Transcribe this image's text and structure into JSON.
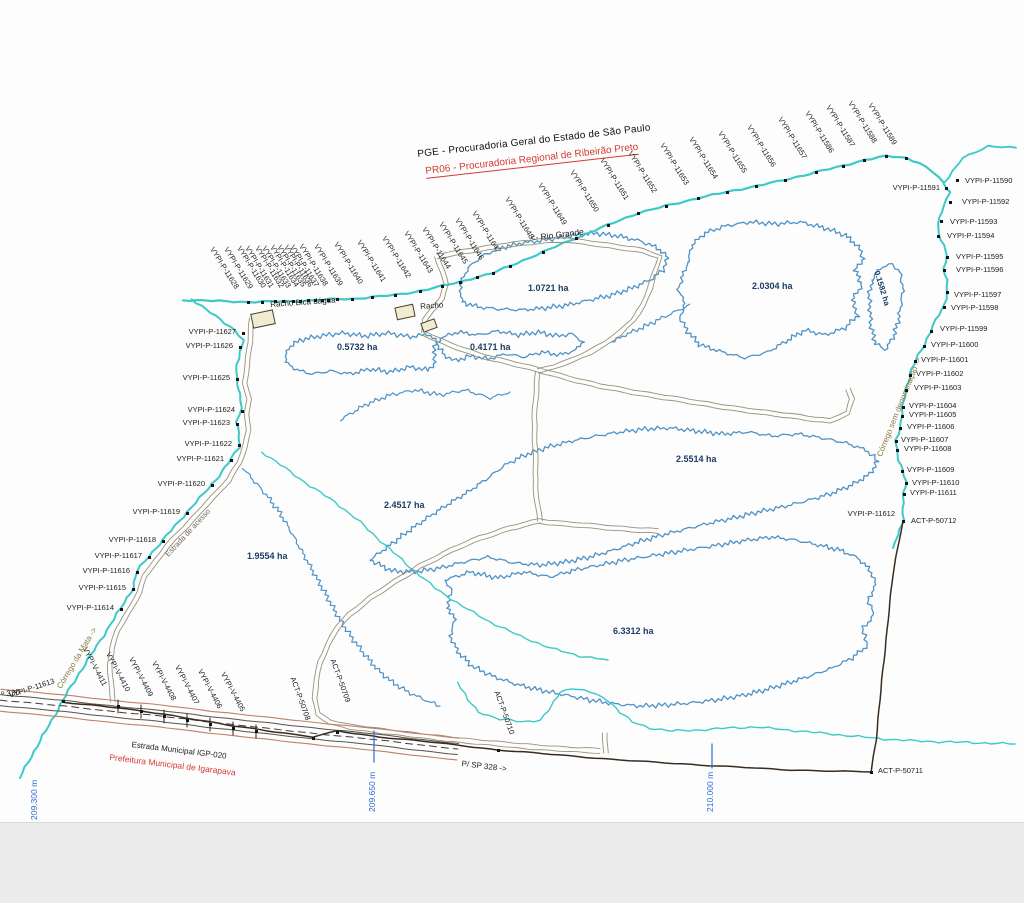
{
  "title": {
    "line1": "PGE - Procuradoria Geral do Estado de São Paulo",
    "line2": "PR06 - Procuradoria Regional de Ribeirão Preto"
  },
  "map": {
    "colors": {
      "stream": "#3ec9c9",
      "polygon": "#4f92c6",
      "road": "#98927a",
      "boundary": "#3a2b1e",
      "highway_edge": "#c08166",
      "highway_inner": "#57524a",
      "label": "#1c1c1c",
      "area_label": "#1c3e63",
      "red": "#d43a31",
      "coord_blue": "#2b6bd6",
      "stream_label": "#8a7b46",
      "building_fill": "#f1ebd0"
    },
    "areas_ha": [
      "0.5732",
      "0.4171",
      "1.0721",
      "2.0304",
      "0.1582",
      "2.5514",
      "2.4517",
      "1.9554",
      "6.3312"
    ],
    "labels": [
      {
        "t": "VYPI-P-11628",
        "x": 215,
        "y": 246,
        "r": 58,
        "c": "rt"
      },
      {
        "t": "VYPI-P-11629",
        "x": 229,
        "y": 246,
        "r": 58,
        "c": "rt"
      },
      {
        "t": "VYPI-P-11630",
        "x": 242,
        "y": 245,
        "r": 58,
        "c": "rt"
      },
      {
        "t": "VYPI-P-11631",
        "x": 250,
        "y": 245,
        "r": 58,
        "c": "rt"
      },
      {
        "t": "VYPI-P-11632",
        "x": 260,
        "y": 245,
        "r": 58,
        "c": "rt"
      },
      {
        "t": "VYPI-P-11633",
        "x": 267,
        "y": 245,
        "r": 58,
        "c": "rt"
      },
      {
        "t": "VYPI-P-11634",
        "x": 275,
        "y": 244,
        "r": 58,
        "c": "rt"
      },
      {
        "t": "VYPI-P-11635",
        "x": 282,
        "y": 244,
        "r": 58,
        "c": "rt"
      },
      {
        "t": "VYPI-P-11636",
        "x": 289,
        "y": 244,
        "r": 58,
        "c": "rt"
      },
      {
        "t": "VYPI-P-11637",
        "x": 295,
        "y": 244,
        "r": 58,
        "c": "rt"
      },
      {
        "t": "VYPI-P-11638",
        "x": 304,
        "y": 243,
        "r": 58,
        "c": "rt"
      },
      {
        "t": "VYPI-P-11639",
        "x": 319,
        "y": 243,
        "r": 58,
        "c": "rt"
      },
      {
        "t": "VYPI-P-11640",
        "x": 339,
        "y": 241,
        "r": 58,
        "c": "rt"
      },
      {
        "t": "VYPI-P-11641",
        "x": 362,
        "y": 239,
        "r": 58,
        "c": "rt"
      },
      {
        "t": "VYPI-P-11642",
        "x": 387,
        "y": 235,
        "r": 58,
        "c": "rt"
      },
      {
        "t": "VYPI-P-11643",
        "x": 409,
        "y": 230,
        "r": 58,
        "c": "rt"
      },
      {
        "t": "VYPI-P-11644",
        "x": 427,
        "y": 226,
        "r": 58,
        "c": "rt"
      },
      {
        "t": "VYPI-P-11645",
        "x": 444,
        "y": 221,
        "r": 58,
        "c": "rt"
      },
      {
        "t": "VYPI-P-11646",
        "x": 460,
        "y": 217,
        "r": 58,
        "c": "rt"
      },
      {
        "t": "VYPI-P-11647",
        "x": 477,
        "y": 210,
        "r": 58,
        "c": "rt"
      },
      {
        "t": "VYPI-P-11648",
        "x": 510,
        "y": 196,
        "r": 58,
        "c": "rt"
      },
      {
        "t": "VYPI-P-11649",
        "x": 543,
        "y": 182,
        "r": 58,
        "c": "rt"
      },
      {
        "t": "VYPI-P-11650",
        "x": 575,
        "y": 169,
        "r": 58,
        "c": "rt"
      },
      {
        "t": "VYPI-P-11651",
        "x": 605,
        "y": 157,
        "r": 58,
        "c": "rt"
      },
      {
        "t": "VYPI-P-11652",
        "x": 633,
        "y": 150,
        "r": 58,
        "c": "rt"
      },
      {
        "t": "VYPI-P-11653",
        "x": 665,
        "y": 142,
        "r": 58,
        "c": "rt"
      },
      {
        "t": "VYPI-P-11654",
        "x": 694,
        "y": 136,
        "r": 58,
        "c": "rt"
      },
      {
        "t": "VYPI-P-11655",
        "x": 723,
        "y": 130,
        "r": 58,
        "c": "rt"
      },
      {
        "t": "VYPI-P-11656",
        "x": 752,
        "y": 124,
        "r": 58,
        "c": "rt"
      },
      {
        "t": "VYPI-P-11657",
        "x": 783,
        "y": 116,
        "r": 58,
        "c": "rt"
      },
      {
        "t": "VYPI-P-11586",
        "x": 810,
        "y": 110,
        "r": 58,
        "c": "rt"
      },
      {
        "t": "VYPI-P-11587",
        "x": 831,
        "y": 104,
        "r": 58,
        "c": "rt"
      },
      {
        "t": "VYPI-P-11588",
        "x": 853,
        "y": 100,
        "r": 58,
        "c": "rt"
      },
      {
        "t": "VYPI-P-11589",
        "x": 873,
        "y": 102,
        "r": 58,
        "c": "rt"
      },
      {
        "t": "VYPI-P-11590",
        "x": 965,
        "y": 177,
        "c": "pt"
      },
      {
        "t": "VYPI-P-11591",
        "x": 940,
        "y": 184,
        "c": "ra"
      },
      {
        "t": "VYPI-P-11592",
        "x": 962,
        "y": 198,
        "c": "pt"
      },
      {
        "t": "VYPI-P-11593",
        "x": 950,
        "y": 218,
        "c": "pt"
      },
      {
        "t": "VYPI-P-11594",
        "x": 947,
        "y": 232,
        "c": "pt"
      },
      {
        "t": "VYPI-P-11595",
        "x": 956,
        "y": 253,
        "c": "pt"
      },
      {
        "t": "VYPI-P-11596",
        "x": 956,
        "y": 266,
        "c": "pt"
      },
      {
        "t": "VYPI-P-11597",
        "x": 954,
        "y": 291,
        "c": "pt"
      },
      {
        "t": "VYPI-P-11598",
        "x": 951,
        "y": 304,
        "c": "pt"
      },
      {
        "t": "VYPI-P-11599",
        "x": 940,
        "y": 325,
        "c": "pt"
      },
      {
        "t": "VYPI-P-11600",
        "x": 931,
        "y": 341,
        "c": "pt"
      },
      {
        "t": "VYPI-P-11601",
        "x": 921,
        "y": 356,
        "c": "pt"
      },
      {
        "t": "VYPI-P-11602",
        "x": 916,
        "y": 370,
        "c": "pt"
      },
      {
        "t": "VYPI-P-11603",
        "x": 914,
        "y": 384,
        "c": "pt"
      },
      {
        "t": "VYPI-P-11604",
        "x": 909,
        "y": 402,
        "c": "pt"
      },
      {
        "t": "VYPI-P-11605",
        "x": 909,
        "y": 411,
        "c": "pt"
      },
      {
        "t": "VYPI-P-11606",
        "x": 907,
        "y": 423,
        "c": "pt"
      },
      {
        "t": "VYPI-P-11607",
        "x": 901,
        "y": 436,
        "c": "pt"
      },
      {
        "t": "VYPI-P-11608",
        "x": 904,
        "y": 445,
        "c": "pt"
      },
      {
        "t": "VYPI-P-11609",
        "x": 907,
        "y": 466,
        "c": "pt"
      },
      {
        "t": "VYPI-P-11610",
        "x": 912,
        "y": 479,
        "c": "pt"
      },
      {
        "t": "VYPI-P-11611",
        "x": 910,
        "y": 489,
        "c": "pt"
      },
      {
        "t": "VYPI-P-11612",
        "x": 895,
        "y": 510,
        "c": "ra"
      },
      {
        "t": "ACT-P-50712",
        "x": 911,
        "y": 517,
        "c": "pt"
      },
      {
        "t": "VYPI-P-11627",
        "x": 236,
        "y": 328,
        "c": "ra"
      },
      {
        "t": "VYPI-P-11626",
        "x": 233,
        "y": 342,
        "c": "ra"
      },
      {
        "t": "VYPI-P-11625",
        "x": 230,
        "y": 374,
        "c": "ra"
      },
      {
        "t": "VYPI-P-11624",
        "x": 235,
        "y": 406,
        "c": "ra"
      },
      {
        "t": "VYPI-P-11623",
        "x": 230,
        "y": 419,
        "c": "ra"
      },
      {
        "t": "VYPI-P-11622",
        "x": 232,
        "y": 440,
        "c": "ra"
      },
      {
        "t": "VYPI-P-11621",
        "x": 224,
        "y": 455,
        "c": "ra"
      },
      {
        "t": "VYPI-P-11620",
        "x": 205,
        "y": 480,
        "c": "ra"
      },
      {
        "t": "VYPI-P-11619",
        "x": 180,
        "y": 508,
        "c": "ra"
      },
      {
        "t": "VYPI-P-11618",
        "x": 156,
        "y": 536,
        "c": "ra"
      },
      {
        "t": "VYPI-P-11617",
        "x": 142,
        "y": 552,
        "c": "ra"
      },
      {
        "t": "VYPI-P-11616",
        "x": 130,
        "y": 567,
        "c": "ra"
      },
      {
        "t": "VYPI-P-11615",
        "x": 126,
        "y": 584,
        "c": "ra"
      },
      {
        "t": "VYPI-P-11614",
        "x": 114,
        "y": 604,
        "c": "ra"
      },
      {
        "t": "VYPI-P-11613",
        "x": 8,
        "y": 692,
        "r": -18,
        "c": "pt"
      },
      {
        "t": "VYPI-V-4411",
        "x": 88,
        "y": 646,
        "r": 62,
        "c": "rt"
      },
      {
        "t": "VYPI-V-4410",
        "x": 111,
        "y": 651,
        "r": 62,
        "c": "rt"
      },
      {
        "t": "VYPI-V-4409",
        "x": 134,
        "y": 656,
        "r": 62,
        "c": "rt"
      },
      {
        "t": "VYPI-V-4408",
        "x": 157,
        "y": 660,
        "r": 62,
        "c": "rt"
      },
      {
        "t": "VYPI-V-4407",
        "x": 180,
        "y": 664,
        "r": 62,
        "c": "rt"
      },
      {
        "t": "VYPI-V-4406",
        "x": 203,
        "y": 668,
        "r": 62,
        "c": "rt"
      },
      {
        "t": "VYPI-V-4405",
        "x": 226,
        "y": 671,
        "r": 62,
        "c": "rt"
      },
      {
        "t": "ACT-P-50708",
        "x": 296,
        "y": 676,
        "r": 70,
        "c": "rt"
      },
      {
        "t": "ACT-P-50709",
        "x": 336,
        "y": 658,
        "r": 70,
        "c": "rt"
      },
      {
        "t": "ACT-P-50710",
        "x": 500,
        "y": 690,
        "r": 70,
        "c": "rt"
      },
      {
        "t": "ACT-P-50711",
        "x": 878,
        "y": 767,
        "c": "pt"
      },
      {
        "t": "0.5732 ha",
        "x": 337,
        "y": 343,
        "c": "area"
      },
      {
        "t": "0.4171 ha",
        "x": 470,
        "y": 343,
        "c": "area"
      },
      {
        "t": "1.0721 ha",
        "x": 528,
        "y": 284,
        "c": "area"
      },
      {
        "t": "2.0304 ha",
        "x": 752,
        "y": 282,
        "c": "area"
      },
      {
        "t": "0.1582 ha",
        "x": 880,
        "y": 270,
        "r": 73,
        "c": "areaR"
      },
      {
        "t": "2.5514 ha",
        "x": 676,
        "y": 455,
        "c": "area"
      },
      {
        "t": "2.4517 ha",
        "x": 384,
        "y": 501,
        "c": "area"
      },
      {
        "t": "1.9554 ha",
        "x": 247,
        "y": 552,
        "c": "area"
      },
      {
        "t": "6.3312 ha",
        "x": 613,
        "y": 627,
        "c": "area"
      },
      {
        "t": "<- Rio Grande",
        "x": 530,
        "y": 234,
        "r": -7,
        "c": "rio"
      },
      {
        "t": "Racho Bica dágua",
        "x": 270,
        "y": 301,
        "r": -4,
        "c": "blk"
      },
      {
        "t": "Racho",
        "x": 420,
        "y": 303,
        "r": -4,
        "c": "blk"
      },
      {
        "t": "Córrego da Mata ->",
        "x": 56,
        "y": 686,
        "r": -59,
        "c": "stream"
      },
      {
        "t": "Córrego sem denominação ->",
        "x": 876,
        "y": 455,
        "r": -68,
        "c": "stream"
      },
      {
        "t": "Estrada de acesso",
        "x": 164,
        "y": 553,
        "r": -47,
        "c": "roadlbl"
      },
      {
        "t": "Estrada Municipal IGP-020",
        "x": 132,
        "y": 741,
        "r": 7,
        "c": "blk"
      },
      {
        "t": "Prefeitura Municipal de Igarapava",
        "x": 110,
        "y": 753,
        "r": 7,
        "c": "red"
      },
      {
        "t": "P/ SP 328 ->",
        "x": 462,
        "y": 760,
        "r": 7,
        "c": "blk"
      },
      {
        "t": "º 330",
        "x": 1,
        "y": 691,
        "r": -8,
        "c": "blk"
      },
      {
        "t": "209.300 m",
        "x": 30,
        "y": 820,
        "r": -90,
        "c": "coord"
      },
      {
        "t": "209.650 m",
        "x": 368,
        "y": 812,
        "r": -90,
        "c": "coord"
      },
      {
        "t": "210.000 m",
        "x": 706,
        "y": 812,
        "r": -90,
        "c": "coord"
      }
    ],
    "survey_points": [
      [
        248,
        302
      ],
      [
        262,
        302
      ],
      [
        275,
        301
      ],
      [
        283,
        301
      ],
      [
        293,
        301
      ],
      [
        300,
        301
      ],
      [
        308,
        300
      ],
      [
        315,
        300
      ],
      [
        322,
        300
      ],
      [
        328,
        300
      ],
      [
        337,
        299
      ],
      [
        352,
        299
      ],
      [
        372,
        297
      ],
      [
        395,
        295
      ],
      [
        420,
        291
      ],
      [
        442,
        286
      ],
      [
        460,
        282
      ],
      [
        477,
        277
      ],
      [
        493,
        273
      ],
      [
        510,
        266
      ],
      [
        543,
        252
      ],
      [
        576,
        238
      ],
      [
        608,
        225
      ],
      [
        638,
        213
      ],
      [
        666,
        206
      ],
      [
        698,
        198
      ],
      [
        727,
        192
      ],
      [
        756,
        186
      ],
      [
        785,
        180
      ],
      [
        816,
        172
      ],
      [
        843,
        166
      ],
      [
        864,
        160
      ],
      [
        886,
        156
      ],
      [
        906,
        158
      ],
      [
        957,
        180
      ],
      [
        946,
        188
      ],
      [
        950,
        202
      ],
      [
        941,
        221
      ],
      [
        938,
        236
      ],
      [
        947,
        257
      ],
      [
        944,
        270
      ],
      [
        947,
        292
      ],
      [
        944,
        307
      ],
      [
        931,
        331
      ],
      [
        924,
        346
      ],
      [
        915,
        361
      ],
      [
        910,
        375
      ],
      [
        906,
        390
      ],
      [
        903,
        407
      ],
      [
        902,
        416
      ],
      [
        900,
        428
      ],
      [
        896,
        441
      ],
      [
        897,
        450
      ],
      [
        902,
        471
      ],
      [
        906,
        483
      ],
      [
        904,
        494
      ],
      [
        903,
        521
      ],
      [
        243,
        333
      ],
      [
        240,
        347
      ],
      [
        237,
        379
      ],
      [
        242,
        411
      ],
      [
        237,
        424
      ],
      [
        239,
        445
      ],
      [
        231,
        460
      ],
      [
        212,
        485
      ],
      [
        187,
        513
      ],
      [
        163,
        541
      ],
      [
        149,
        557
      ],
      [
        137,
        572
      ],
      [
        133,
        589
      ],
      [
        121,
        609
      ],
      [
        63,
        701
      ],
      [
        118,
        706
      ],
      [
        141,
        711
      ],
      [
        164,
        716
      ],
      [
        187,
        720
      ],
      [
        210,
        724
      ],
      [
        233,
        728
      ],
      [
        256,
        731
      ],
      [
        313,
        738
      ],
      [
        337,
        732
      ],
      [
        498,
        750
      ],
      [
        871,
        772
      ]
    ]
  }
}
